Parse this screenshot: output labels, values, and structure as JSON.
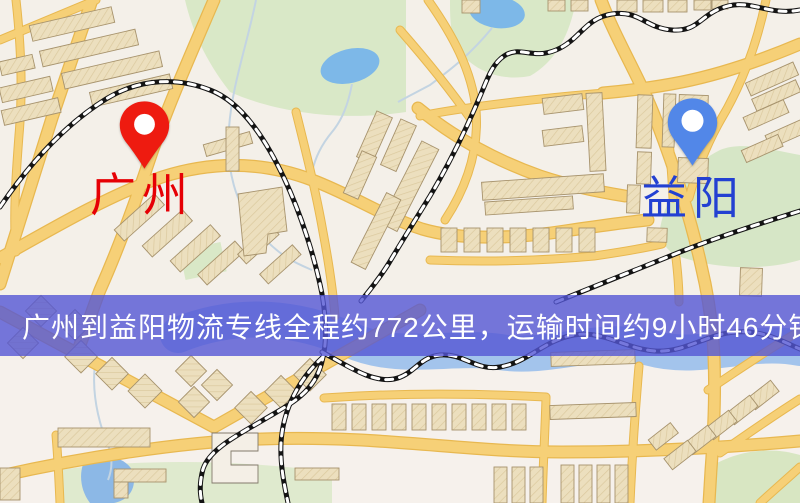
{
  "map": {
    "origin": {
      "name": "广州",
      "pin_color": "#ee1b10",
      "label_color": "#e60005"
    },
    "destination": {
      "name": "益阳",
      "pin_color": "#5287e8",
      "label_color": "#2340d2"
    }
  },
  "banner": {
    "text": "广州到益阳物流专线全程约772公里，运输时间约9小时46分钟.",
    "distance_km": 772,
    "duration_text": "9小时46分钟",
    "background_color": "rgba(84,86,213,0.80)",
    "text_color": "#ffffff"
  },
  "map_palette": {
    "background": "#f4f0e9",
    "road": "#f6d077",
    "road_casing": "#e8b850",
    "park": "#d9e8c7",
    "water": "#a3c4ec",
    "pond": "#7db8e8",
    "building": "#ecdfbe",
    "railway": "#141414"
  }
}
